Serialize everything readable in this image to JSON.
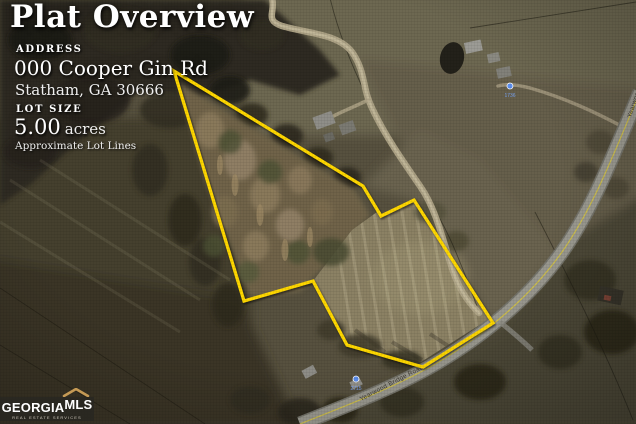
{
  "header": {
    "title": "Plat Overview"
  },
  "info": {
    "address_label": "ADDRESS",
    "address_line1": "000 Cooper Gin Rd",
    "address_line2": "Statham, GA 30666",
    "lot_size_label": "LOT SIZE",
    "lot_size_value": "5.00",
    "lot_size_unit": "acres",
    "lot_note": "Approximate Lot Lines"
  },
  "map": {
    "type": "satellite-aerial",
    "plat_outline_vertices_px": "174,71 363,186 381,216 414,200 493,323 423,367 347,345 313,281 244,301",
    "road_label": "Yearwood Bridge Road",
    "markers": [
      {
        "label": "1736"
      },
      {
        "label": "2715"
      }
    ]
  },
  "logo": {
    "brand_primary": "GEORGIA",
    "brand_secondary": "MLS",
    "tagline": "REAL ESTATE SERVICES"
  },
  "colors": {
    "plat-yellow": "#ffd800",
    "road-centerline": "#d2c24a",
    "marker-blue": "#5b8ff0",
    "logo-gold": "#c59a55"
  }
}
